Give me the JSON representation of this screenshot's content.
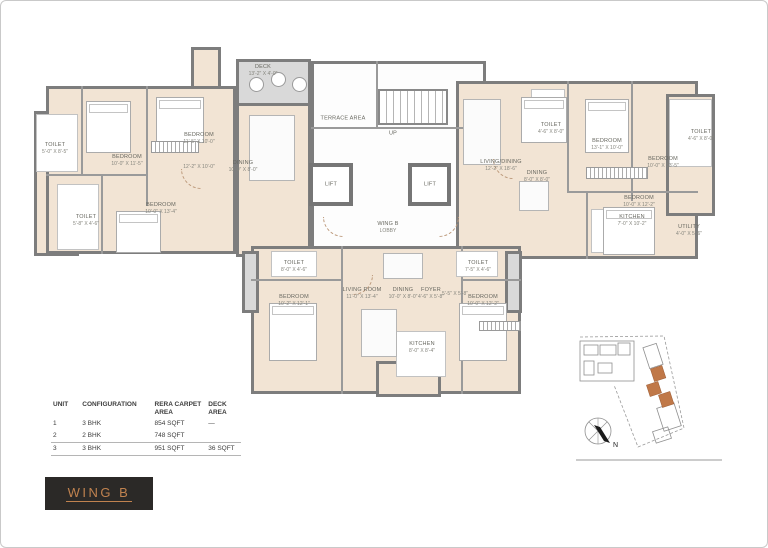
{
  "wing": {
    "label": "WING B"
  },
  "table": {
    "headers": [
      "UNIT",
      "CONFIGURATION",
      "RERA CARPET AREA",
      "DECK AREA"
    ],
    "rows": [
      {
        "unit": "1",
        "config": "3 BHK",
        "carpet": "854 SQFT",
        "deck": "—"
      },
      {
        "unit": "2",
        "config": "2 BHK",
        "carpet": "748 SQFT",
        "deck": ""
      },
      {
        "unit": "3",
        "config": "3 BHK",
        "carpet": "951 SQFT",
        "deck": "36 SQFT"
      }
    ]
  },
  "plan": {
    "rooms": [
      {
        "n": "TOILET",
        "d": "5'-0\" X 8'-5\"",
        "x": 24,
        "y": 110
      },
      {
        "n": "BEDROOM",
        "d": "10'-0\" X 11'-5\"",
        "x": 96,
        "y": 122
      },
      {
        "n": "BEDROOM",
        "d": "11'-5\" X 10'-0\"",
        "x": 168,
        "y": 100
      },
      {
        "n": "",
        "d": "12'-2\" X 10'-0\"",
        "x": 168,
        "y": 128
      },
      {
        "n": "BEDROOM",
        "d": "10'-0\" X 13'-4\"",
        "x": 130,
        "y": 170
      },
      {
        "n": "TOILET",
        "d": "5'-8\" X 4'-6\"",
        "x": 55,
        "y": 182
      },
      {
        "n": "DECK",
        "d": "13'-2\" X 4'-0\"",
        "x": 232,
        "y": 32
      },
      {
        "n": "DINING",
        "d": "10'-0\" X 8'-0\"",
        "x": 212,
        "y": 128
      },
      {
        "n": "TERRACE AREA",
        "d": "",
        "x": 312,
        "y": 80
      },
      {
        "n": "UP",
        "d": "",
        "x": 362,
        "y": 95
      },
      {
        "n": "LIFT",
        "d": "",
        "x": 300,
        "y": 146
      },
      {
        "n": "LIFT",
        "d": "",
        "x": 399,
        "y": 146
      },
      {
        "n": "WING B",
        "d": "LOBBY",
        "x": 357,
        "y": 189
      },
      {
        "n": "LIVING/DINING",
        "d": "12'-2\" X 18'-6\"",
        "x": 470,
        "y": 127
      },
      {
        "n": "TOILET",
        "d": "4'-6\" X 8'-0\"",
        "x": 520,
        "y": 90
      },
      {
        "n": "DINING",
        "d": "8'-0\" X 8'-0\"",
        "x": 506,
        "y": 138
      },
      {
        "n": "BEDROOM",
        "d": "13'-1\" X 10'-0\"",
        "x": 576,
        "y": 106
      },
      {
        "n": "BEDROOM",
        "d": "10'-0\" X 13'-5\"",
        "x": 632,
        "y": 124
      },
      {
        "n": "TOILET",
        "d": "4'-6\" X 8'-0\"",
        "x": 670,
        "y": 97
      },
      {
        "n": "BEDROOM",
        "d": "10'-0\" X 12'-2\"",
        "x": 608,
        "y": 163
      },
      {
        "n": "KITCHEN",
        "d": "7'-0\" X 10'-2\"",
        "x": 601,
        "y": 182
      },
      {
        "n": "UTILITY",
        "d": "4'-0\" X 5'-6\"",
        "x": 658,
        "y": 192
      },
      {
        "n": "TOILET",
        "d": "8'-0\" X 4'-6\"",
        "x": 263,
        "y": 228
      },
      {
        "n": "BEDROOM",
        "d": "10'-2\" X 12'-1\"",
        "x": 263,
        "y": 262
      },
      {
        "n": "LIVING ROOM",
        "d": "11'-0\" X 13'-4\"",
        "x": 331,
        "y": 255
      },
      {
        "n": "DINING",
        "d": "10'-0\" X 8'-0\"",
        "x": 372,
        "y": 255
      },
      {
        "n": "FOYER",
        "d": "4'-6\" X 5'-8\"",
        "x": 400,
        "y": 255
      },
      {
        "n": "",
        "d": "5'-5\" X 5'-8\"",
        "x": 424,
        "y": 255
      },
      {
        "n": "TOILET",
        "d": "7'-5\" X 4'-6\"",
        "x": 447,
        "y": 228
      },
      {
        "n": "BEDROOM",
        "d": "10'-0\" X 12'-2\"",
        "x": 452,
        "y": 262
      },
      {
        "n": "KITCHEN",
        "d": "8'-0\" X 8'-4\"",
        "x": 391,
        "y": 309
      }
    ]
  },
  "keyplan": {
    "north_label": "N"
  },
  "colors": {
    "accent": "#c0824f",
    "badge_bg": "#2b2927",
    "wall": "#7d7d7d",
    "floor": "#f2e4d4",
    "deck": "#d9d9d9",
    "keyplan_highlight": "#c07848"
  }
}
